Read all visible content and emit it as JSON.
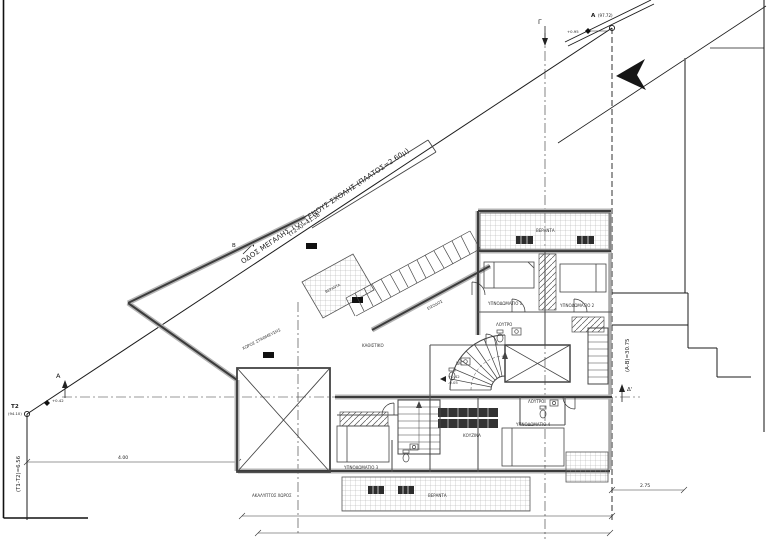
{
  "drawing": {
    "street": {
      "name": "ΟΔΟΣ ΜΕΓΑΛΗΣ ΤΟΥ ΓΕΝΟΥΣ ΣΧΟΛΗΣ (ΠΛΑΤΟΣ=2.60μ)",
      "frontage_dim": "(Τ2-Α)=41.38"
    },
    "survey_points": {
      "a_label": "Α",
      "a_elevation": "(97.72)",
      "a_level": "+0.95",
      "t2_label": "Τ2",
      "t2_elevation": "(94.10)",
      "t2_level": "+0.42"
    },
    "boundaries": {
      "right_dim": "(Α-Β)=30.75",
      "left_dim": "(Τ1-Τ2)=6.56",
      "side_offset_dim": "4.00",
      "rear_offset_dim": "2.75"
    },
    "section_markers": {
      "top": "Γ",
      "left": "Α",
      "right": "Δ'",
      "street": "Β"
    },
    "levels": {
      "entry": "+0.42",
      "court": "-0.05"
    },
    "rooms": {
      "parking": "ΧΩΡΟΣ ΣΤΑΘΜΕΥΣΗΣ",
      "living": "ΚΑΘΙΣΤΙΚΟ",
      "entrance": "ΕΙΣΟΔΟΣ",
      "bedroom1": "ΥΠΝΟΔΩΜΑΤΙΟ 1",
      "bedroom2": "ΥΠΝΟΔΩΜΑΤΙΟ 2",
      "bedroom3": "ΥΠΝΟΔΩΜΑΤΙΟ 3",
      "bedroom4": "ΥΠΝΟΔΩΜΑΤΙΟ 4",
      "bathroom": "ΛΟΥΤΡΟ",
      "wc": "WC",
      "kitchen": "ΚΟΥΖΙΝΑ",
      "veranda": "ΒΕΡΑΝΤΑ",
      "open_court": "ΑΚΑΛΥΠΤΟΣ ΧΩΡΟΣ"
    },
    "colors": {
      "line": "#1b1b1b",
      "wall_fill": "#b5b5b5",
      "hatch": "#666666"
    }
  }
}
